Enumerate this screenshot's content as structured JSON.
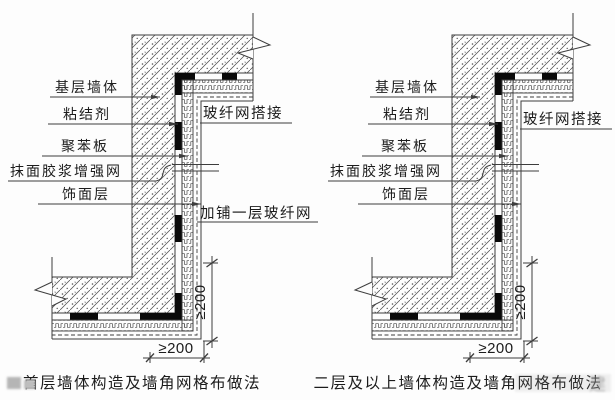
{
  "page": {
    "background": "#fdfdfd",
    "line_color": "#3d3d3d"
  },
  "diagrams": [
    {
      "id": "first-floor",
      "caption": "首层墙体构造及墙角网格布做法",
      "labels": {
        "base_wall": "基层墙体",
        "adhesive": "粘结剂",
        "eps_board": "聚苯板",
        "mesh_render": "抹面胶浆增强网",
        "finish_layer": "饰面层",
        "mesh_overlap": "玻纤网搭接",
        "extra_mesh": "加铺一层玻纤网"
      },
      "dimensions": {
        "vertical": "≥200",
        "horizontal": "≥200"
      }
    },
    {
      "id": "upper-floors",
      "caption": "二层及以上墙体构造及墙角网格布做法",
      "labels": {
        "base_wall": "基层墙体",
        "adhesive": "粘结剂",
        "eps_board": "聚苯板",
        "mesh_render": "抹面胶浆增强网",
        "finish_layer": "饰面层",
        "mesh_overlap": "玻纤网搭接"
      },
      "dimensions": {
        "vertical": "≥200",
        "horizontal": "≥200"
      }
    }
  ],
  "watermark": {
    "caption_overlay": "建"
  }
}
